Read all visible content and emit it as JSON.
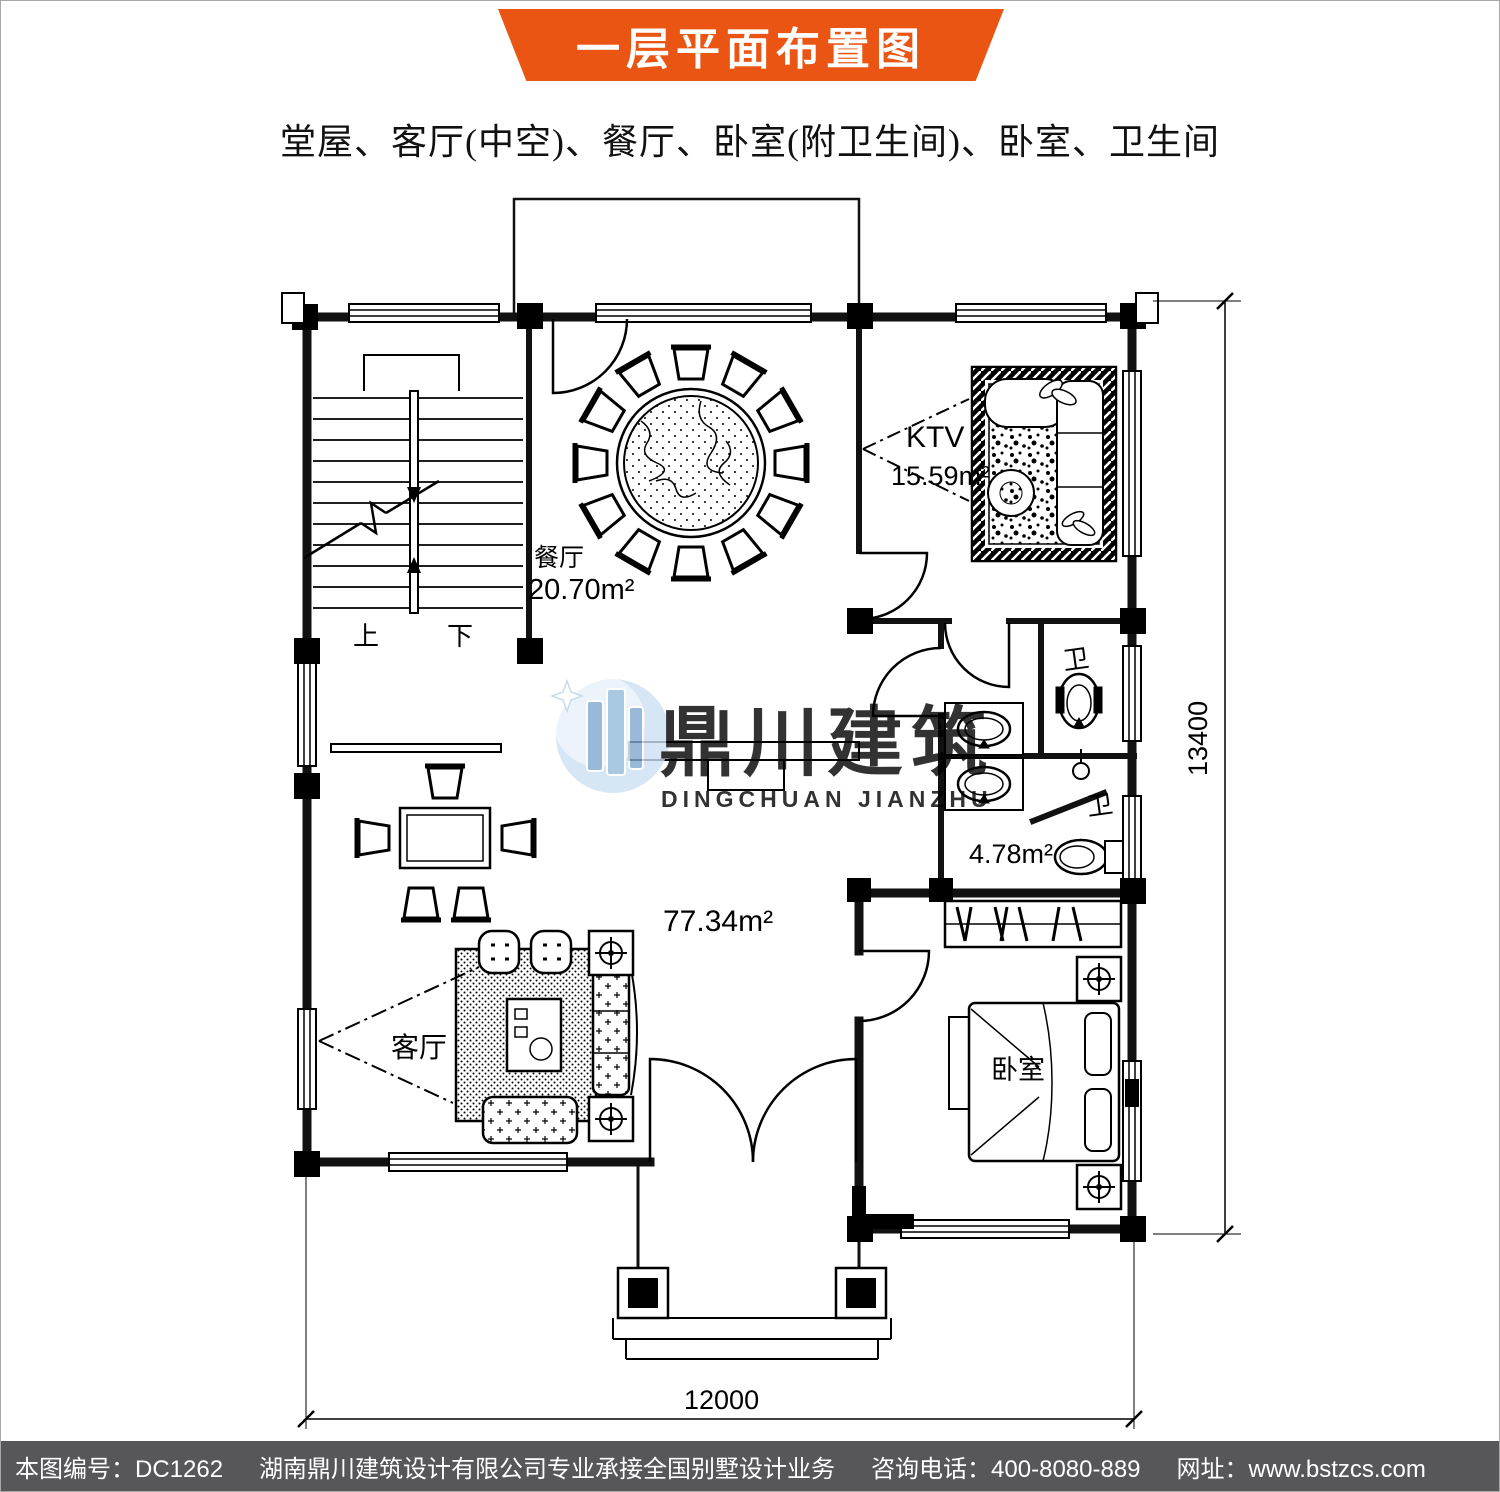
{
  "header": {
    "banner_title": "一层平面布置图",
    "subtitle": "堂屋、客厅(中空)、餐厅、卧室(附卫生间)、卧室、卫生间"
  },
  "colors": {
    "banner_orange": "#ea5514",
    "footer_gray": "#57575a",
    "watermark_blue": "#8ab4da",
    "watermark_gray": "#a3a3a3"
  },
  "rooms": {
    "dining": {
      "name": "餐厅",
      "area": "20.70m²"
    },
    "ktv": {
      "name": "KTV",
      "area": "15.59m²"
    },
    "hall": {
      "area": "77.34m²"
    },
    "living": {
      "name": "客厅"
    },
    "bedroom": {
      "name": "卧室"
    },
    "bath_upper": {
      "label": "卫"
    },
    "bath_lower": {
      "label": "卫",
      "area": "4.78m²"
    },
    "stairs": {
      "up": "上",
      "down": "下"
    }
  },
  "dimensions": {
    "height_total": "13400",
    "width_total": "12000"
  },
  "watermark": {
    "name_cn": "鼎川建筑",
    "name_en": "DINGCHUAN JIANZHU"
  },
  "footer": {
    "doc_no": "本图编号：DC1262",
    "company": "湖南鼎川建筑设计有限公司专业承接全国别墅设计业务",
    "phone": "咨询电话：400-8080-889",
    "website": "网址：www.bstzcs.com"
  }
}
